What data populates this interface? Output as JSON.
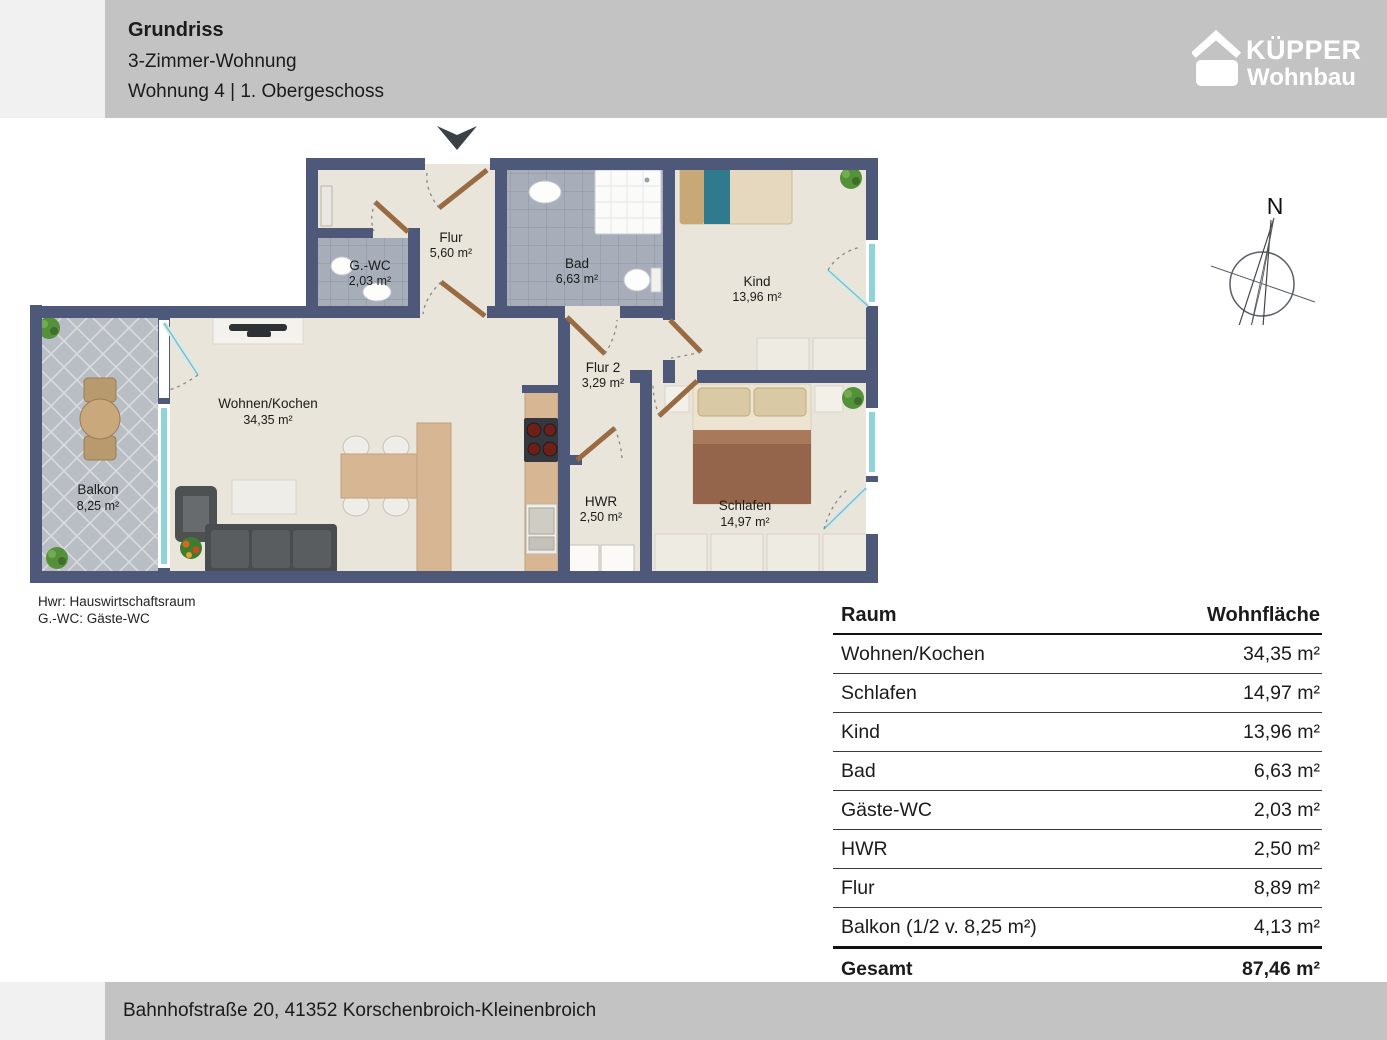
{
  "header": {
    "title": "Grundriss",
    "subtitle": "3-Zimmer-Wohnung",
    "unit_line": "Wohnung 4 | 1. Obergeschoss"
  },
  "logo": {
    "name": "KÜPPER",
    "sub": "Wohnbau"
  },
  "compass": {
    "north_label": "N"
  },
  "floorplan": {
    "rooms": [
      {
        "name": "Flur",
        "area": "5,60 m²"
      },
      {
        "name": "G.-WC",
        "area": "2,03 m²"
      },
      {
        "name": "Bad",
        "area": "6,63 m²"
      },
      {
        "name": "Kind",
        "area": "13,96 m²"
      },
      {
        "name": "Wohnen/Kochen",
        "area": "34,35 m²"
      },
      {
        "name": "Balkon",
        "area": "8,25 m²"
      },
      {
        "name": "Flur 2",
        "area": "3,29 m²"
      },
      {
        "name": "HWR",
        "area": "2,50 m²"
      },
      {
        "name": "Schlafen",
        "area": "14,97 m²"
      }
    ],
    "legend": [
      "Hwr: Hauswirtschaftsraum",
      "G.-WC: Gäste-WC"
    ]
  },
  "table": {
    "headers": {
      "room": "Raum",
      "area": "Wohnfläche"
    },
    "rows": [
      {
        "room": "Wohnen/Kochen",
        "area": "34,35 m²"
      },
      {
        "room": "Schlafen",
        "area": "14,97 m²"
      },
      {
        "room": "Kind",
        "area": "13,96 m²"
      },
      {
        "room": "Bad",
        "area": "6,63 m²"
      },
      {
        "room": "Gäste-WC",
        "area": "2,03 m²"
      },
      {
        "room": "HWR",
        "area": "2,50 m²"
      },
      {
        "room": "Flur",
        "area": "8,89 m²"
      },
      {
        "room": "Balkon (1/2 v. 8,25 m²)",
        "area": "4,13 m²"
      }
    ],
    "total": {
      "room": "Gesamt",
      "area": "87,46 m²"
    }
  },
  "footer": {
    "address": "Bahnhofstraße 20, 41352 Korschenbroich-Kleinenbroich"
  },
  "colors": {
    "wall": "#4e5878",
    "floor": "#eae5da",
    "band": "#c3c3c3",
    "window_teal": "#8fd4d8"
  }
}
